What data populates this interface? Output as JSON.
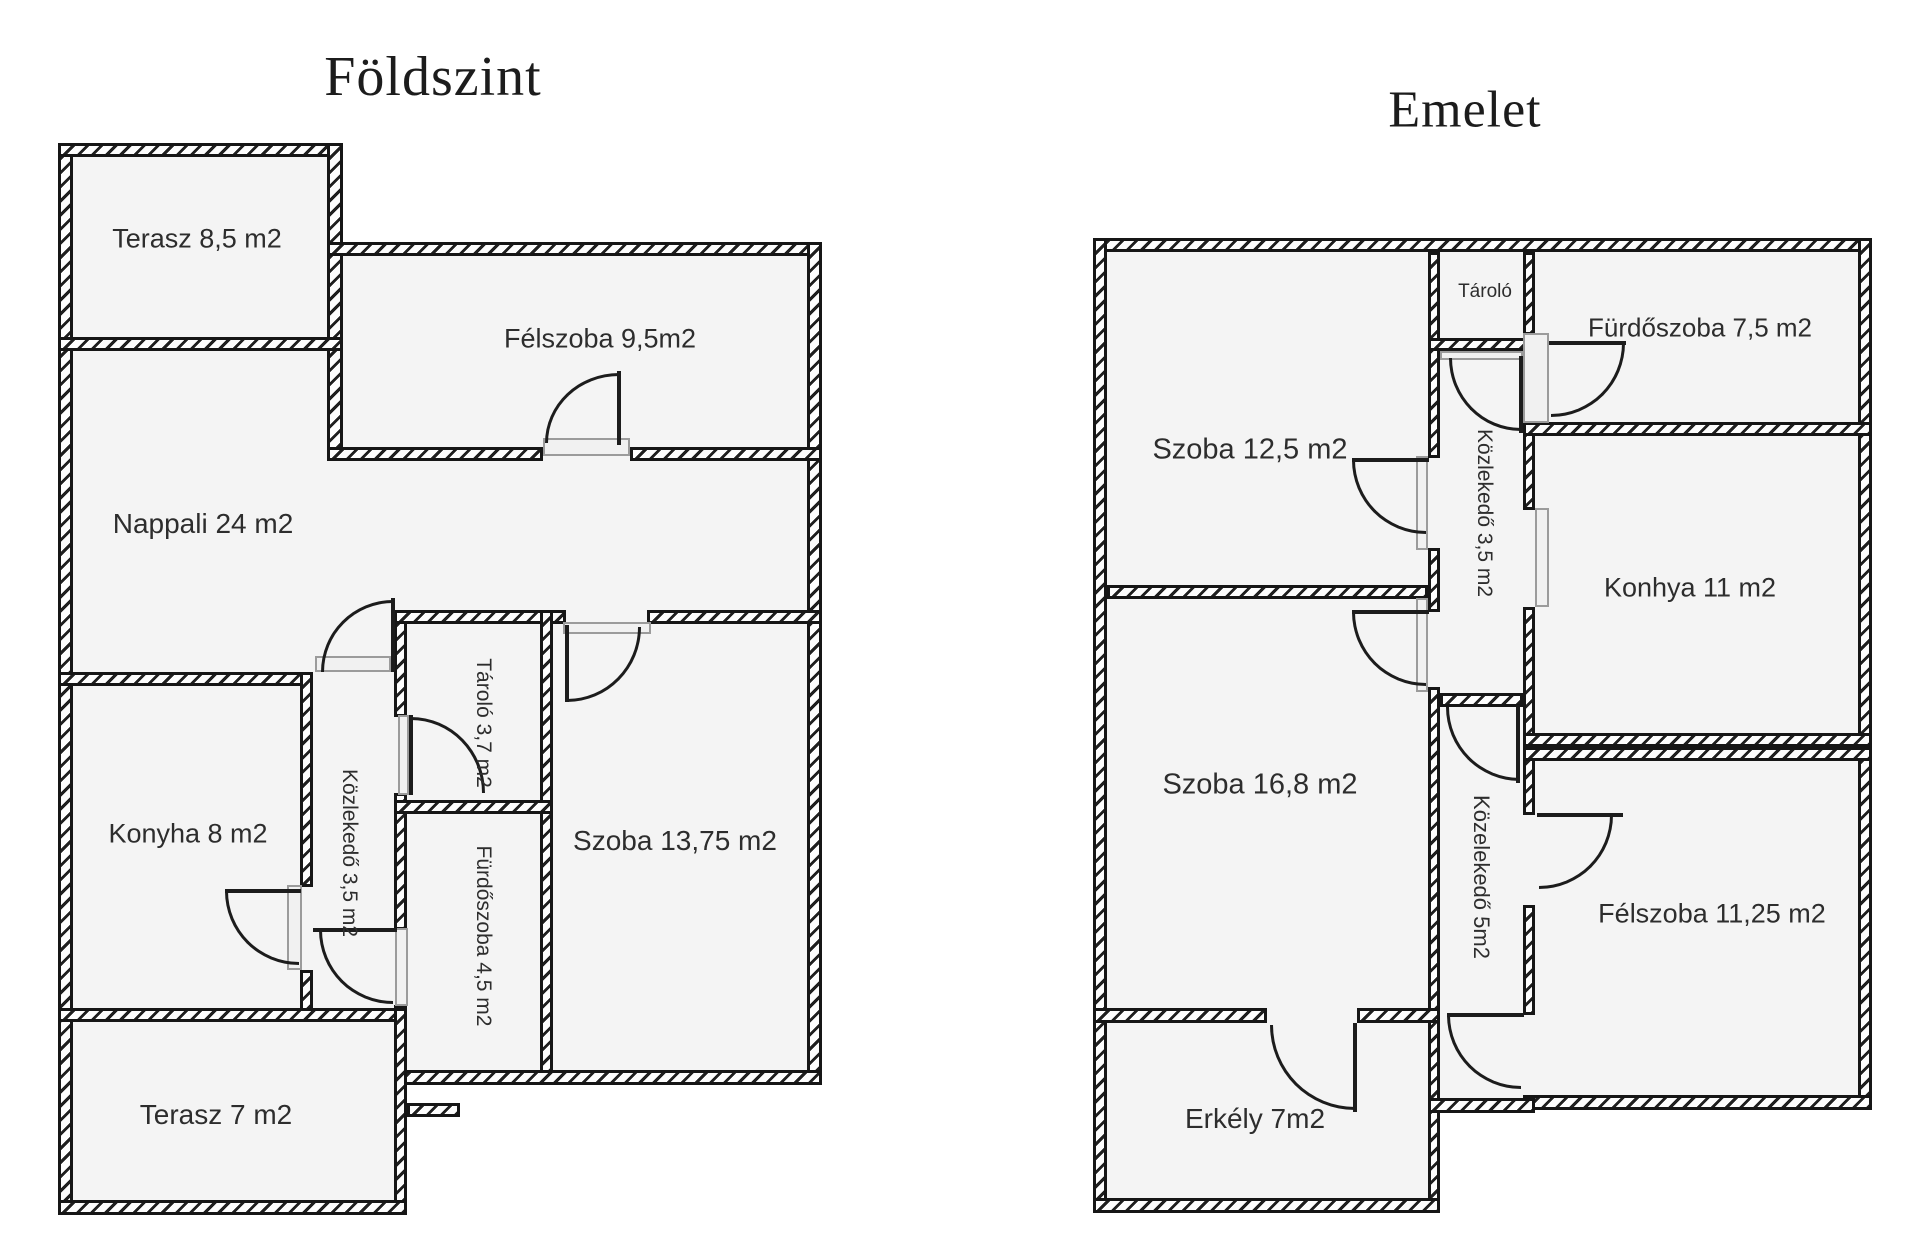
{
  "colors": {
    "wall_line": "#161616",
    "room_fill": "#f4f4f4",
    "hatch_background": "#fdfdfd",
    "door_sill_grey": "#9b9b9b",
    "label_text": "#2d2d2d"
  },
  "floors": [
    {
      "title": "Földszint",
      "rooms": [
        {
          "id": "terasz85",
          "label": "Terasz 8,5 m2"
        },
        {
          "id": "felszoba95",
          "label": "Félszoba 9,5m2"
        },
        {
          "id": "nappali24",
          "label": "Nappali 24 m2"
        },
        {
          "id": "tarolo37",
          "label": "Tároló 3,7 m2"
        },
        {
          "id": "kozlekedo35",
          "label": "Közlekedő 3,5 m2"
        },
        {
          "id": "konyha8",
          "label": "Konyha 8 m2"
        },
        {
          "id": "furdoszoba45",
          "label": "Fürdőszoba 4,5 m2"
        },
        {
          "id": "szoba1375",
          "label": "Szoba 13,75 m2"
        },
        {
          "id": "terasz7",
          "label": "Terasz 7 m2"
        }
      ]
    },
    {
      "title": "Emelet",
      "rooms": [
        {
          "id": "szoba125",
          "label": "Szoba 12,5 m2"
        },
        {
          "id": "tarolo",
          "label": "Tároló"
        },
        {
          "id": "furdoszoba75",
          "label": "Fürdőszoba 7,5 m2"
        },
        {
          "id": "kozlekedo35e",
          "label": "Közlekedő 3,5 m2"
        },
        {
          "id": "konhya11",
          "label": "Konhya 11 m2"
        },
        {
          "id": "szoba168",
          "label": "Szoba 16,8 m2"
        },
        {
          "id": "kozelekedo5",
          "label": "Közelekedő 5m2"
        },
        {
          "id": "felszoba1125",
          "label": "Félszoba 11,25 m2"
        },
        {
          "id": "erkely7",
          "label": "Erkély 7m2"
        }
      ]
    }
  ]
}
